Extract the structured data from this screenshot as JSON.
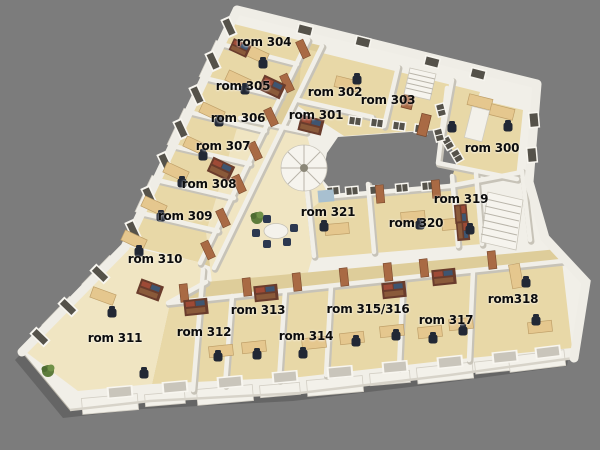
{
  "scene": {
    "kind": "3d-floorplan-render",
    "floor_name": "rom 300–321",
    "background": "#7c7c7c"
  },
  "colors": {
    "background": "#7c7c7c",
    "wall": "#f1efe8",
    "floor": "#e8d8a7",
    "floor_light": "#f0e5c2",
    "corridor": "#decd9a",
    "door": "#a96a44",
    "window": "#55524a",
    "desk": "#e5c78e",
    "chair": "#222835",
    "shelf": "#6a3c2c",
    "plant": "#5d7c3c",
    "label": "#0c0c0c"
  },
  "rooms": [
    {
      "id": "300",
      "label": "rom 300",
      "x": 492,
      "y": 148
    },
    {
      "id": "301",
      "label": "rom 301",
      "x": 316,
      "y": 115
    },
    {
      "id": "302",
      "label": "rom 302",
      "x": 335,
      "y": 92
    },
    {
      "id": "303",
      "label": "rom 303",
      "x": 388,
      "y": 100
    },
    {
      "id": "304",
      "label": "rom 304",
      "x": 264,
      "y": 42
    },
    {
      "id": "305",
      "label": "rom 305",
      "x": 243,
      "y": 86
    },
    {
      "id": "306",
      "label": "rom 306",
      "x": 238,
      "y": 118
    },
    {
      "id": "307",
      "label": "rom 307",
      "x": 223,
      "y": 146
    },
    {
      "id": "308",
      "label": "rom 308",
      "x": 209,
      "y": 184
    },
    {
      "id": "309",
      "label": "rom 309",
      "x": 185,
      "y": 216
    },
    {
      "id": "310",
      "label": "rom 310",
      "x": 155,
      "y": 259
    },
    {
      "id": "311",
      "label": "rom 311",
      "x": 115,
      "y": 338
    },
    {
      "id": "312",
      "label": "rom 312",
      "x": 204,
      "y": 332
    },
    {
      "id": "313",
      "label": "rom 313",
      "x": 258,
      "y": 310
    },
    {
      "id": "314",
      "label": "rom 314",
      "x": 306,
      "y": 336
    },
    {
      "id": "315-316",
      "label": "rom 315/316",
      "x": 368,
      "y": 309
    },
    {
      "id": "317",
      "label": "rom 317",
      "x": 446,
      "y": 320
    },
    {
      "id": "318",
      "label": "rom318",
      "x": 513,
      "y": 299
    },
    {
      "id": "319",
      "label": "rom 319",
      "x": 461,
      "y": 199
    },
    {
      "id": "320",
      "label": "rom 320",
      "x": 416,
      "y": 223
    },
    {
      "id": "321",
      "label": "rom 321",
      "x": 328,
      "y": 212
    }
  ]
}
